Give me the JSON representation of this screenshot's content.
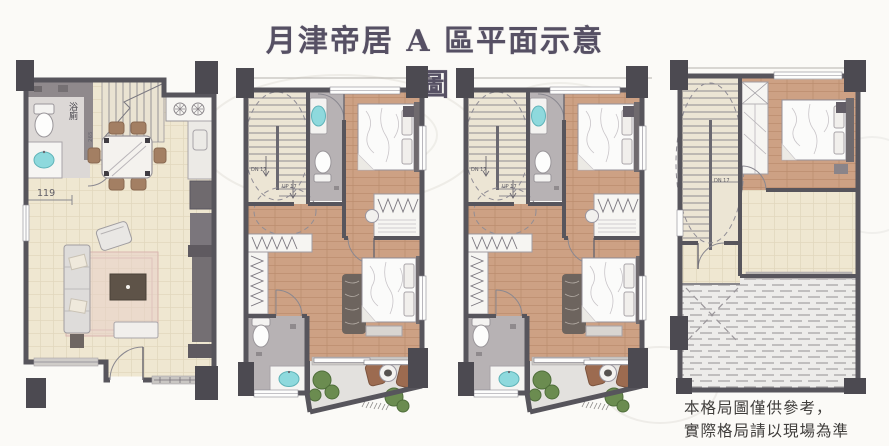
{
  "title": "月津帝居 A 區平面示意圖",
  "disclaimer": {
    "line1": "本格局圖僅供參考，",
    "line2": "實際格局請以現場為準"
  },
  "plans": {
    "floor1": {
      "bath_label": "浴廁",
      "bath_dim": "265",
      "entry_dim": "119"
    },
    "floor2": {
      "dn_label": "DN 17",
      "up_label": "UP 17"
    },
    "floor3": {
      "dn_label": "DN 17",
      "up_label": "UP 17"
    },
    "floor4": {
      "dn_label": "DN 17"
    }
  },
  "colors": {
    "background": "#fbfaf7",
    "wall": "#57555c",
    "column": "#4c4a51",
    "tile_floor": "#efe7d1",
    "wood_floor": "#cda184",
    "bath_floor": "#b7b2b4",
    "sink_teal": "#8ed9dd",
    "rug_pink": "#e8cfc9",
    "plant_green": "#6b8c50",
    "chair_brown": "#9c6b50",
    "roof_gray": "#edecea",
    "title_text": "#565064",
    "note_text": "#403e3c"
  }
}
